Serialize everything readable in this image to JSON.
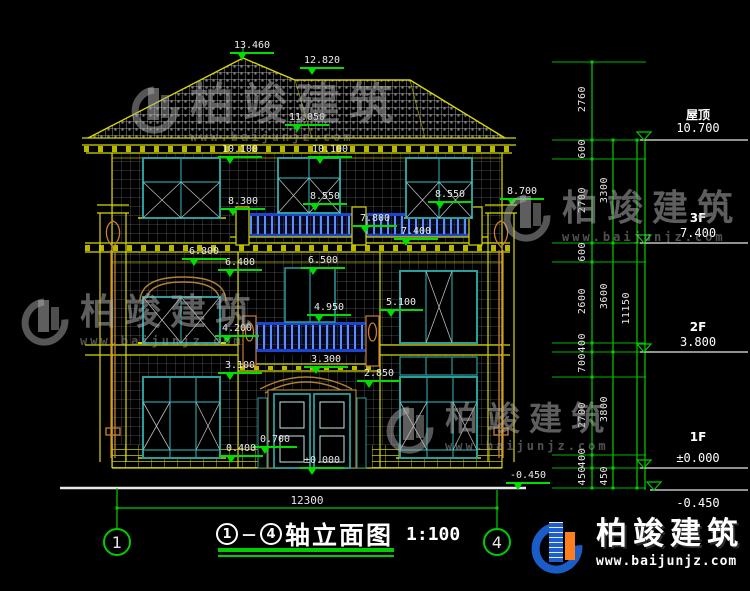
{
  "drawing": {
    "title": {
      "bubble_start": "1",
      "dash": "－",
      "bubble_end": "4",
      "name": "轴立面图",
      "scale": "1:100"
    },
    "bottom_dim": "12300",
    "axis": {
      "left": "1",
      "right": "4"
    },
    "elevation_markers": [
      {
        "value": "13.460"
      },
      {
        "value": "12.820"
      },
      {
        "value": "11.050"
      },
      {
        "value": "10.100"
      },
      {
        "value": "10.100"
      },
      {
        "value": "8.300"
      },
      {
        "value": "8.550"
      },
      {
        "value": "8.550"
      },
      {
        "value": "8.700"
      },
      {
        "value": "7.800"
      },
      {
        "value": "7.400"
      },
      {
        "value": "6.800"
      },
      {
        "value": "6.400"
      },
      {
        "value": "6.500"
      },
      {
        "value": "5.100"
      },
      {
        "value": "4.950"
      },
      {
        "value": "4.200"
      },
      {
        "value": "3.300"
      },
      {
        "value": "3.100"
      },
      {
        "value": "2.850"
      },
      {
        "value": "0.700"
      },
      {
        "value": "0.400"
      },
      {
        "value": "±0.000"
      },
      {
        "value": "-0.450"
      }
    ],
    "right_levels": [
      {
        "name": "屋顶",
        "value": "10.700"
      },
      {
        "name": "3F",
        "value": "7.400"
      },
      {
        "name": "2F",
        "value": "3.800"
      },
      {
        "name": "1F",
        "value": "±0.000"
      },
      {
        "name": "",
        "value": "-0.450"
      }
    ],
    "dim_col1": [
      "2760",
      "600",
      "2700",
      "600",
      "2600",
      "400",
      "700",
      "2700",
      "400",
      "450"
    ],
    "dim_col2": [
      "3300",
      "3600",
      "3800",
      "450"
    ],
    "dim_total": "11150"
  },
  "watermark": {
    "text": "柏竣建筑",
    "url": "www.baijunjz.com"
  },
  "brand": {
    "text": "柏竣建筑",
    "url": "www.baijunjz.com"
  },
  "colors": {
    "line_yellow": "#d8d800",
    "dim_green": "#00dd00",
    "window_teal": "#2a9d9d",
    "baluster_blue": "#1d44cc",
    "accent_orange": "#c87f35",
    "brand_blue": "#1a5cc8",
    "brand_orange": "#ff7f1e"
  }
}
